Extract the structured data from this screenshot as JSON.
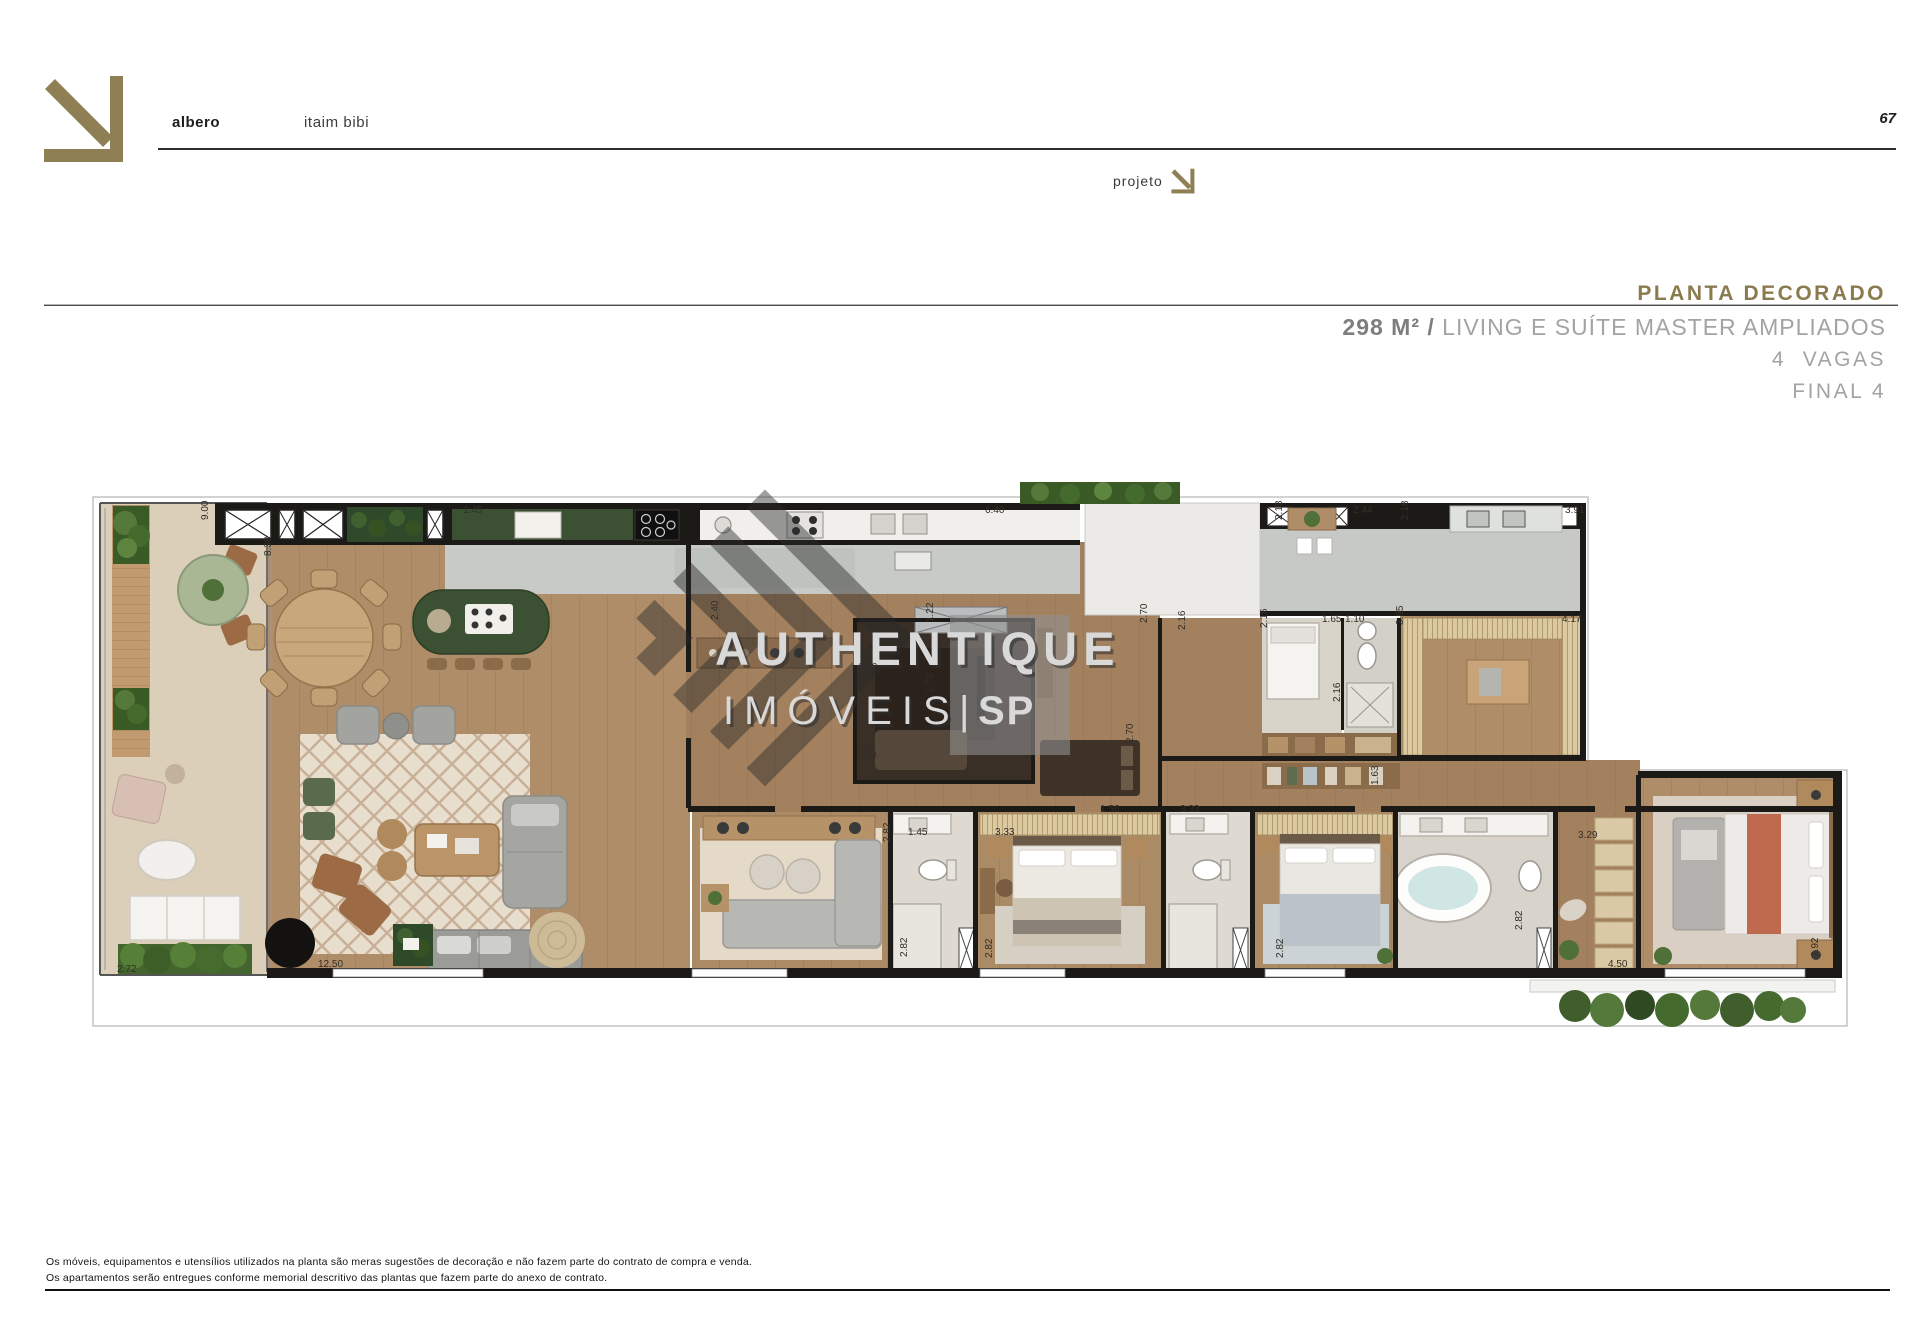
{
  "header": {
    "brand": "albero",
    "location": "itaim bibi",
    "page_number": "67",
    "projeto_label": "projeto"
  },
  "title": {
    "heading": "PLANTA DECORADO",
    "area": "298 M²",
    "separator": " / ",
    "description": "LIVING E SUÍTE MASTER AMPLIADOS",
    "line2": "4  VAGAS",
    "line3": "FINAL 4"
  },
  "watermark": {
    "line1": "AUTHENTIQUE",
    "line2": "IMÓVEIS",
    "divider": "|",
    "suffix": "SP"
  },
  "plan": {
    "dimensions": [
      {
        "t": "9.00",
        "x": 133,
        "y": 42,
        "r": -90
      },
      {
        "t": "8.38",
        "x": 196,
        "y": 78,
        "r": -90
      },
      {
        "t": "1.45",
        "x": 388,
        "y": 35,
        "r": 0
      },
      {
        "t": "6.40",
        "x": 910,
        "y": 35,
        "r": 0
      },
      {
        "t": "2.18",
        "x": 1207,
        "y": 42,
        "r": -90
      },
      {
        "t": "2.44",
        "x": 1278,
        "y": 35,
        "r": 0
      },
      {
        "t": "2.18",
        "x": 1333,
        "y": 42,
        "r": -90
      },
      {
        "t": "3.91",
        "x": 1490,
        "y": 35,
        "r": 0
      },
      {
        "t": "2.16",
        "x": 1192,
        "y": 150,
        "r": -90
      },
      {
        "t": "1.65",
        "x": 1247,
        "y": 144,
        "r": 0
      },
      {
        "t": "1.10",
        "x": 1270,
        "y": 144,
        "r": 0
      },
      {
        "t": "3.95",
        "x": 1328,
        "y": 147,
        "r": -90
      },
      {
        "t": "4.17",
        "x": 1487,
        "y": 144,
        "r": 0
      },
      {
        "t": "2.16",
        "x": 1265,
        "y": 224,
        "r": -90
      },
      {
        "t": "2.40",
        "x": 643,
        "y": 142,
        "r": -90
      },
      {
        "t": "1.90",
        "x": 783,
        "y": 192,
        "r": 0
      },
      {
        "t": "1.90",
        "x": 782,
        "y": 280,
        "r": 0
      },
      {
        "t": "1.22",
        "x": 858,
        "y": 144,
        "r": -90
      },
      {
        "t": "1.73",
        "x": 858,
        "y": 215,
        "r": -90
      },
      {
        "t": "2.70",
        "x": 1072,
        "y": 145,
        "r": -90
      },
      {
        "t": "2.70",
        "x": 1058,
        "y": 265,
        "r": -90
      },
      {
        "t": "2.16",
        "x": 1110,
        "y": 152,
        "r": -90
      },
      {
        "t": "1.63",
        "x": 1303,
        "y": 307,
        "r": -90
      },
      {
        "t": "2.82",
        "x": 815,
        "y": 364,
        "r": -90
      },
      {
        "t": "1.45",
        "x": 833,
        "y": 357,
        "r": 0
      },
      {
        "t": "3.33",
        "x": 920,
        "y": 357,
        "r": 0
      },
      {
        "t": "1.56",
        "x": 1025,
        "y": 334,
        "r": 0
      },
      {
        "t": "3.33",
        "x": 1105,
        "y": 334,
        "r": 0
      },
      {
        "t": "2.82",
        "x": 832,
        "y": 479,
        "r": -90
      },
      {
        "t": "2.82",
        "x": 917,
        "y": 480,
        "r": -90
      },
      {
        "t": "2.82",
        "x": 1208,
        "y": 480,
        "r": -90
      },
      {
        "t": "3.29",
        "x": 1503,
        "y": 360,
        "r": 0
      },
      {
        "t": "2.82",
        "x": 1447,
        "y": 452,
        "r": -90
      },
      {
        "t": "4.50",
        "x": 1533,
        "y": 489,
        "r": 0
      },
      {
        "t": "2.92",
        "x": 1743,
        "y": 479,
        "r": -90
      },
      {
        "t": "12.50",
        "x": 243,
        "y": 489,
        "r": 0
      },
      {
        "t": "2.72",
        "x": 42,
        "y": 494,
        "r": 0
      }
    ]
  },
  "footer": {
    "line1": "Os móveis, equipamentos e utensílios utilizados na planta são meras sugestões de decoração e não fazem parte do contrato de compra e venda.",
    "line2": "Os apartamentos serão entregues conforme memorial descritivo das plantas que fazem parte do anexo de contrato."
  },
  "colors": {
    "accent": "#8e7f55",
    "heading": "#8a7b4e",
    "wall": "#1c1a17",
    "wood": "#b08d69",
    "terrace": "#dccfba",
    "counter-gray": "#c7cac6",
    "marble-green": "#3c5134",
    "foliage": "#4a6b33",
    "terracotta": "#bf6a4f"
  }
}
